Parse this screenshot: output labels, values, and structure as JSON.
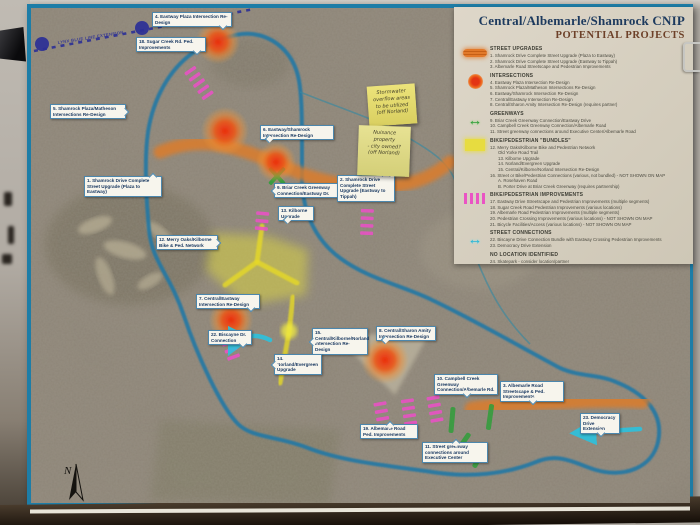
{
  "poster": {
    "border_color": "#1d7da7",
    "legend": {
      "title_line1": "Central/Albemarle/Shamrock CNIP",
      "title_line2": "POTENTIAL PROJECTS",
      "sections": [
        {
          "icon": "street-upgrade-bar",
          "heading": "STREET UPGRADES",
          "items": [
            {
              "text": "1. Shamrock Drive Complete Street Upgrade (Plaza to Eastway)"
            },
            {
              "text": "2. Shamrock Drive Complete Street Upgrade (Eastway to Tippah)"
            },
            {
              "text": "3. Albemarle Road Streetscape and Pedestrian Improvements"
            }
          ]
        },
        {
          "icon": "intersection-dot",
          "heading": "INTERSECTIONS",
          "items": [
            {
              "text": "4. Eastway Plaza Intersection Re-Design"
            },
            {
              "text": "5. Shamrock Plaza/Matheson Intersections Re-Design"
            },
            {
              "text": "6. Eastway/Shamrock Intersection Re-Design"
            },
            {
              "text": "7. Central/Eastway Intersection Re-Design"
            },
            {
              "text": "8. Central/Sharon Amity Intersection Re-Design (requires partner)"
            }
          ]
        },
        {
          "icon": "greenway-arrow",
          "heading": "GREENWAYS",
          "items": [
            {
              "text": "9. Briar Creek Greenway Connection/Eastway Drive"
            },
            {
              "text": "10. Campbell Creek Greenway Connection/Albemarle Road"
            },
            {
              "text": "11. Street greenway connections around Executive Center/Albemarle Road"
            }
          ]
        },
        {
          "icon": "bundle-square",
          "heading": "BIKE/PEDESTRIAN \"BUNDLES\"",
          "items": [
            {
              "text": "12. Merry Oaks/Kilborne Bike and Pedestrian Network"
            },
            {
              "text": "Old Yorke Road Trail",
              "indent": true
            },
            {
              "text": "13. Kilborne Upgrade",
              "indent": true
            },
            {
              "text": "14. Norland/Evergreen Upgrade",
              "indent": true
            },
            {
              "text": "15. Central/Kilborne/Norland Intersection Re-Design",
              "indent": true
            },
            {
              "text": "16. Street or Bike/Pedestrian Connections (various, not bundled) - NOT SHOWN ON MAP"
            },
            {
              "text": "A. Rosehaven Road",
              "indent": true
            },
            {
              "text": "B. Porter Drive at Briar Creek Greenway (requires partnership)",
              "indent": true
            }
          ]
        },
        {
          "icon": "ped-dashes",
          "heading": "BIKE/PEDESTRIAN IMPROVEMENTS",
          "items": [
            {
              "text": "17. Eastway Drive Streetscape and Pedestrian Improvements (multiple segments)"
            },
            {
              "text": "18. Sugar Creek Road Pedestrian Improvements (various locations)"
            },
            {
              "text": "19. Albemarle Road Pedestrian Improvements (multiple segments)"
            },
            {
              "text": "20. Pedestrian Crossing Improvements (various locations) - NOT SHOWN ON MAP"
            },
            {
              "text": "21. Bicycle Facilities/Access (various locations) - NOT SHOWN ON MAP"
            }
          ]
        },
        {
          "icon": "street-connection-arrow",
          "heading": "STREET CONNECTIONS",
          "items": [
            {
              "text": "22. Biscayne Drive Connection Bundle with Eastway Crossing Pedestrian Improvements"
            },
            {
              "text": "23. Democracy Drive Extension"
            }
          ]
        },
        {
          "icon": "none",
          "heading": "NO LOCATION IDENTIFIED",
          "items": [
            {
              "text": "24. Skatepark - consider location/partner"
            },
            {
              "text": "25. Dog park - consider location/partner"
            },
            {
              "text": "26. Pocket park(s) - consider location/partner"
            }
          ]
        }
      ]
    },
    "map": {
      "colors": {
        "boundary": "#2278a5",
        "orange": "#e07c28",
        "red": "#e93014",
        "pink": "#ec4fc8",
        "yellow": "#e6d928",
        "green": "#2f9e3a",
        "cyan": "#2cc2de",
        "lynx": "#2b2f96"
      },
      "lynx": {
        "label": "LYNX BLUE LINE EXTENSION",
        "d": "M34,51 L254,9",
        "dots": [
          [
            42,
            44
          ],
          [
            142,
            28
          ]
        ],
        "label_x": 58,
        "label_y": 44,
        "label_rot": -9
      },
      "north_label": "N",
      "boundary_d": "M232,36 C262,27 291,46 298,76 C302,92 302,120 302,150 L302,180 C303,214 316,240 340,258 C368,279 404,286 432,300 C470,318 512,342 560,368 C580,377 598,374 616,382 C646,394 664,414 658,442 C652,468 624,478 596,470 C576,464 560,452 536,462 C506,474 470,478 432,472 C392,466 344,462 308,448 C278,436 252,438 238,424 C220,406 196,352 184,316 C170,274 152,262 149,230 C146,196 144,160 148,132 C153,100 168,70 194,52 C206,44 220,39 232,36 Z",
      "creek_d": "M300,92 C340,108 372,118 398,132 C430,150 452,162 458,190 C464,218 470,246 482,272 C494,300 508,322 530,344",
      "teal_area_points": "486,118 560,106 608,112 612,168 556,184 492,162",
      "orange_paths": [
        {
          "d": "M160,152 C190,140 214,142 240,150 C268,158 284,168 308,176 C334,184 362,188 392,186 C414,184 434,176 450,162",
          "w": 13
        },
        {
          "d": "M472,409 C505,404 540,402 575,401 C600,400 622,400 642,401",
          "w": 15
        }
      ],
      "yellow": {
        "area_points": "212,233 268,236 308,250 306,295 246,305 206,270",
        "lines": [
          "M262,226 L257,262 L225,285",
          "M257,262 L297,283",
          "M293,297 L289,332 L280,383"
        ],
        "glow": {
          "x": 289,
          "y": 331,
          "r": 8
        }
      },
      "blobs": [
        {
          "x": 218,
          "y": 42,
          "r": 22
        },
        {
          "x": 225,
          "y": 131,
          "r": 24
        },
        {
          "x": 276,
          "y": 162,
          "r": 20
        },
        {
          "x": 231,
          "y": 320,
          "r": 22
        },
        {
          "x": 385,
          "y": 360,
          "r": 24
        }
      ],
      "pink_ladders": [
        {
          "x": 199,
          "y": 83,
          "a": 55,
          "n": 5
        },
        {
          "x": 262,
          "y": 221,
          "a": 95,
          "n": 3
        },
        {
          "x": 367,
          "y": 222,
          "a": 92,
          "n": 4
        },
        {
          "x": 231,
          "y": 350,
          "a": 70,
          "n": 3
        },
        {
          "x": 382,
          "y": 415,
          "a": 80,
          "n": 4
        },
        {
          "x": 409,
          "y": 412,
          "a": 82,
          "n": 4
        },
        {
          "x": 435,
          "y": 409,
          "a": 80,
          "n": 4
        }
      ],
      "green_bars": [
        {
          "x": 452,
          "y": 420,
          "a": 5
        },
        {
          "x": 490,
          "y": 417,
          "a": 8
        },
        {
          "x": 462,
          "y": 444,
          "a": 35
        },
        {
          "x": 480,
          "y": 456,
          "a": 28
        }
      ],
      "green_x": [
        {
          "x": 277,
          "y": 176
        }
      ],
      "cyan_arrows": [
        "M270,340 C254,332 238,336 231,350",
        "M640,429 L576,433"
      ],
      "callouts": [
        {
          "text": "4. Eastway Plaza Intersection Re-Design",
          "x": 152,
          "y": 12,
          "w": 80,
          "tail": "br"
        },
        {
          "text": "18. Sugar Creek Rd. Ped. Improvements",
          "x": 136,
          "y": 37,
          "w": 70,
          "tail": "br"
        },
        {
          "text": "5. Shamrock Plaza/Matheson Intersections Re-Design",
          "x": 50,
          "y": 104,
          "w": 76,
          "tail": "r"
        },
        {
          "text": "1. Shamrock Drive Complete Street Upgrade (Plaza to Eastway)",
          "x": 84,
          "y": 176,
          "w": 78,
          "tail": "tr"
        },
        {
          "text": "6. Eastway/Shamrock Intersection Re-Design",
          "x": 260,
          "y": 125,
          "w": 74,
          "tail": "bl"
        },
        {
          "text": "9. Briar Creek Greenway Connection/Eastway Dr.",
          "x": 274,
          "y": 183,
          "w": 68,
          "tail": "l"
        },
        {
          "text": "2. Shamrock Drive Complete Street Upgrade (Eastway to Tippah)",
          "x": 337,
          "y": 175,
          "w": 58,
          "tail": "tr"
        },
        {
          "text": "12. Merry Oaks/Kilborne Bike & Ped. Network",
          "x": 156,
          "y": 235,
          "w": 62,
          "tail": "r"
        },
        {
          "text": "13. Kilborne Upgrade",
          "x": 278,
          "y": 206,
          "w": 36,
          "tail": "bl"
        },
        {
          "text": "7. Central/Eastway Intersection Re-Design",
          "x": 196,
          "y": 294,
          "w": 64,
          "tail": "br"
        },
        {
          "text": "15. Central/Kilborne/Norland Intersection Re-Design",
          "x": 312,
          "y": 328,
          "w": 56,
          "tail": "l"
        },
        {
          "text": "22. Biscayne Dr. Connection",
          "x": 208,
          "y": 330,
          "w": 44,
          "tail": "br"
        },
        {
          "text": "14. Norland/Evergreen Upgrade",
          "x": 274,
          "y": 354,
          "w": 48,
          "tail": "l"
        },
        {
          "text": "8. Central/Sharon Amity Intersection Re-Design",
          "x": 376,
          "y": 326,
          "w": 60,
          "tail": "bl"
        },
        {
          "text": "10. Campbell Creek Greenway Connection/Albemarle Rd.",
          "x": 434,
          "y": 374,
          "w": 64,
          "tail": "b"
        },
        {
          "text": "3. Albemarle Road Streetscape & Ped. Improvements",
          "x": 500,
          "y": 381,
          "w": 64,
          "tail": "b"
        },
        {
          "text": "19. Albemarle Road Ped. Improvements",
          "x": 360,
          "y": 424,
          "w": 58,
          "tail": "t"
        },
        {
          "text": "11. Street greenway connections around Executive Center",
          "x": 422,
          "y": 442,
          "w": 66,
          "tail": "t"
        },
        {
          "text": "23. Democracy Drive Extension",
          "x": 580,
          "y": 413,
          "w": 40,
          "tail": "b"
        }
      ],
      "sticky_notes": [
        {
          "lines": [
            "Stormwater",
            "overflow areas",
            "to be utilized",
            "(off Norland)"
          ],
          "x": 368,
          "y": 85,
          "w": 48,
          "h": 40,
          "rot": -4
        },
        {
          "lines": [
            "Nuisance",
            "property",
            "- city owned?",
            "(off Norland)"
          ],
          "x": 358,
          "y": 126,
          "w": 52,
          "h": 50,
          "rot": 2
        }
      ]
    }
  }
}
